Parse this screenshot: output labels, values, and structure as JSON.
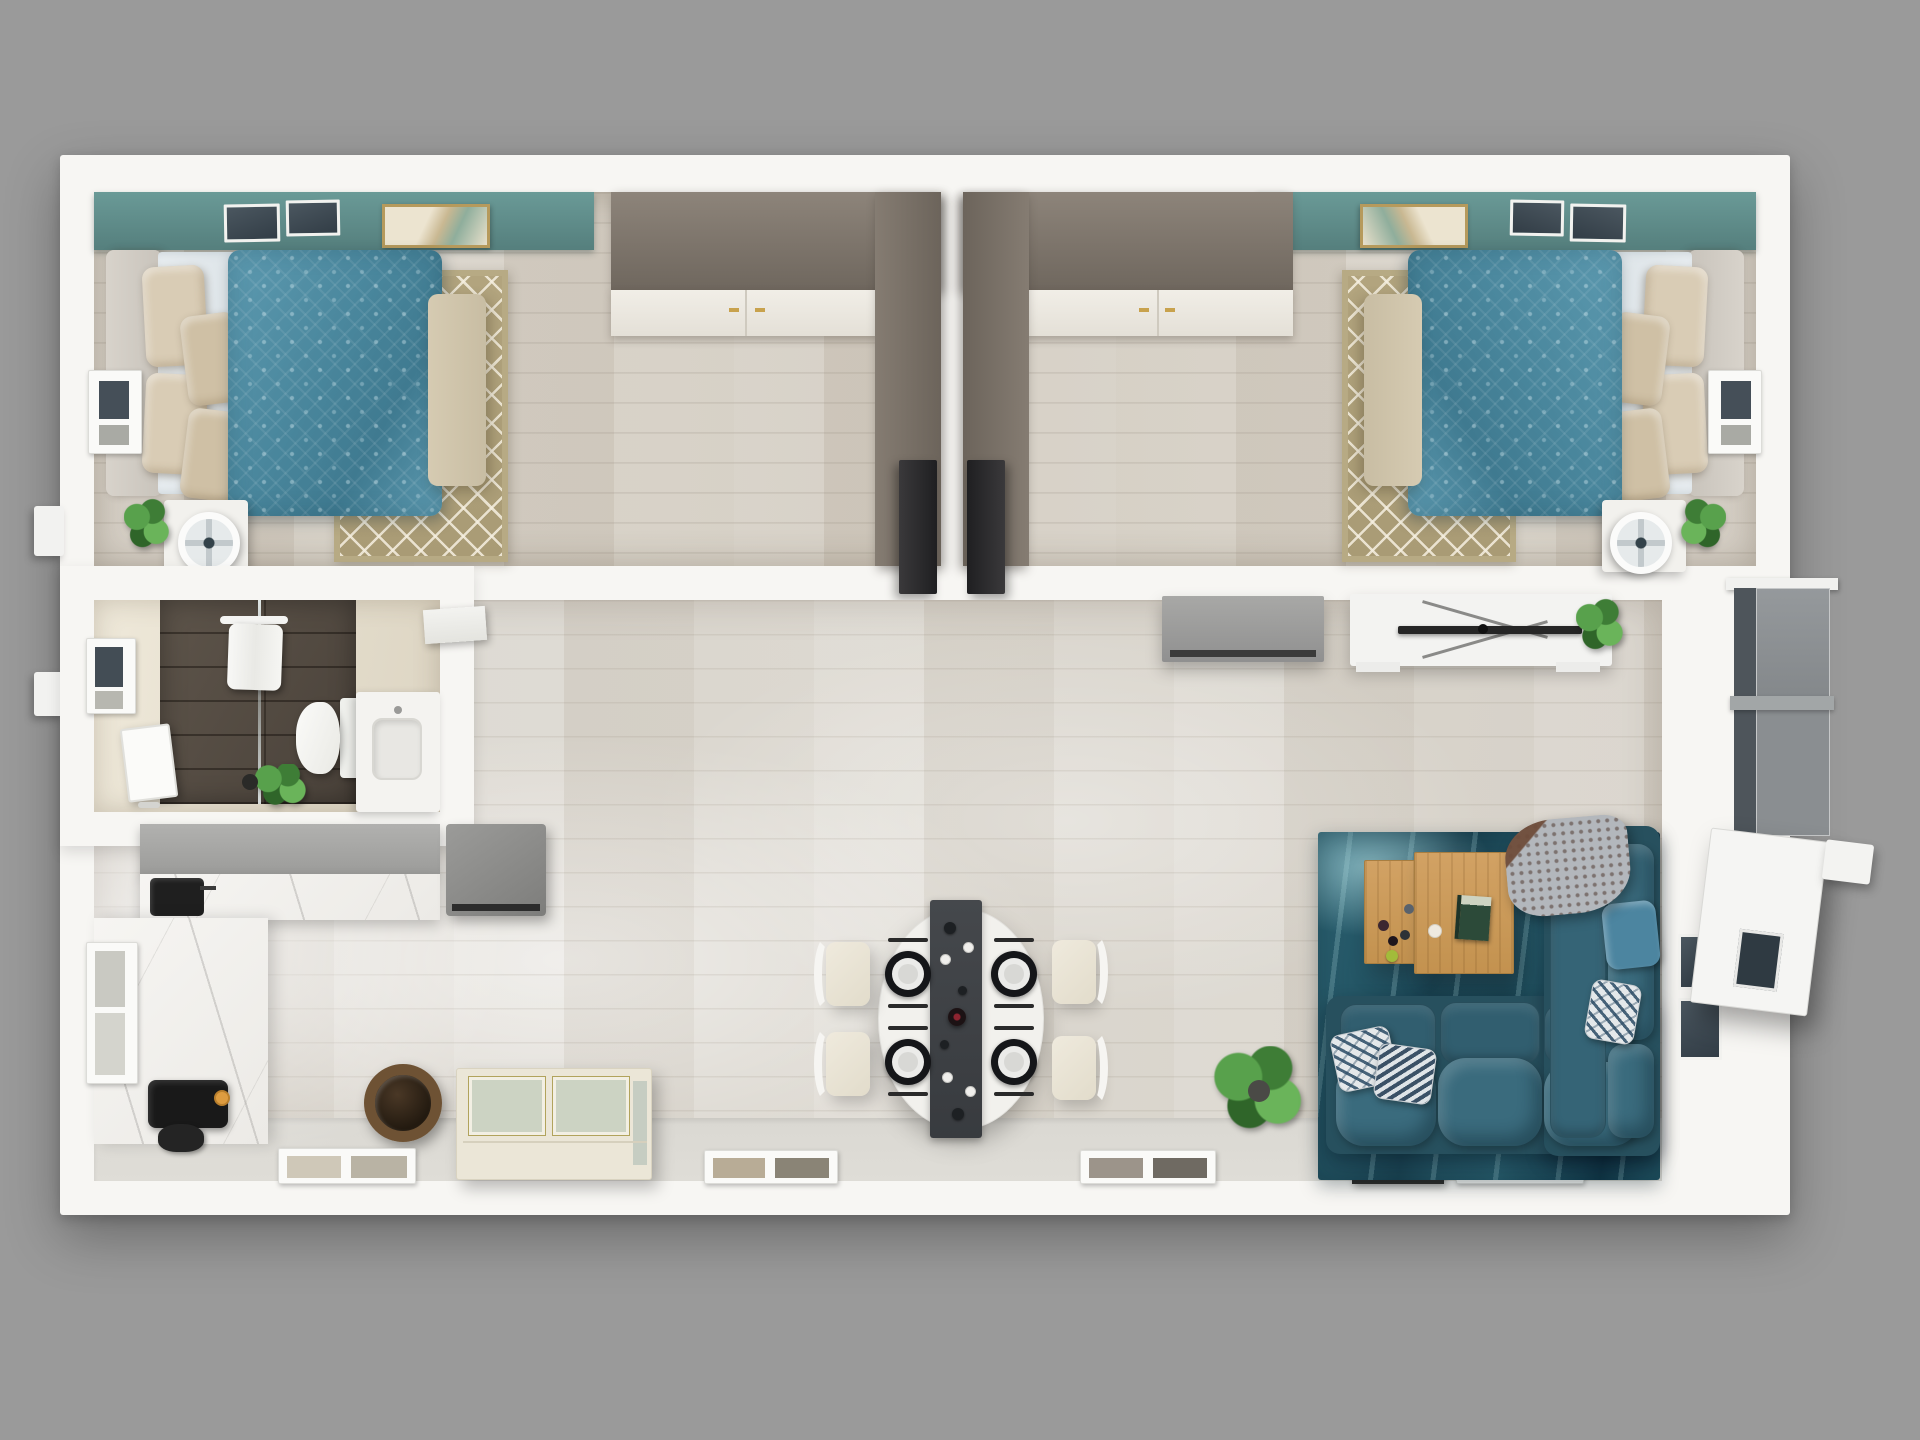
{
  "scene": {
    "description": "Top-down 3D rendered floor plan of a rectangular single-storey home with two mirrored bedrooms at the top, a bathroom at the middle-left, and an open-plan kitchen, dining and living area across the bottom, on a plain grey background.",
    "style": "photorealistic 3D floor plan render, no text labels",
    "background_color": "#9a9a9a",
    "wall_color": "#f7f6f3"
  },
  "counts": {
    "bedrooms": 2,
    "bathrooms": 1,
    "dining_seats": 4,
    "place_settings": 4
  },
  "rooms": [
    {
      "name": "Bedroom 1",
      "position": "top-left",
      "items": [
        "double bed with teal damask duvet",
        "grey upholstered headboard",
        "four beige satin pillows",
        "cream bench at foot of bed",
        "taupe diamond-pattern area rug",
        "white nightstand with fan and plant",
        "L-shaped taupe wardrobe with white cabinet doors",
        "two dark skylight windows",
        "framed wall art",
        "teal accent wall strip",
        "side wall window",
        "dark open door"
      ]
    },
    {
      "name": "Bedroom 2",
      "position": "top-right",
      "note": "mirror image of Bedroom 1",
      "items": [
        "double bed with teal damask duvet",
        "grey upholstered headboard",
        "four beige satin pillows",
        "cream bench at foot of bed",
        "taupe diamond-pattern area rug",
        "white nightstand with fan and plant",
        "L-shaped taupe wardrobe with white cabinet doors",
        "two dark skylight windows",
        "framed wall art",
        "teal accent wall strip",
        "side wall window",
        "dark open door"
      ]
    },
    {
      "name": "Bathroom",
      "position": "middle-left",
      "items": [
        "dark-tiled walk-in shower with glass partition",
        "hanging white towel",
        "white wall shelf",
        "toilet",
        "white vanity with inset sink",
        "tilted vanity mirror",
        "potted plant",
        "wall window"
      ]
    },
    {
      "name": "Kitchen",
      "position": "bottom-left",
      "items": [
        "grey upper cabinet run",
        "white marble counter strip",
        "black sink and faucet",
        "grey refrigerator unit",
        "white marble side counter",
        "black coffee machine with orange cup",
        "black kettle",
        "wicker basket",
        "cream glass-front cabinet",
        "wall window"
      ]
    },
    {
      "name": "Dining area",
      "position": "bottom-center",
      "items": [
        "white oval dining table",
        "dark table runner",
        "four black charger place settings with white plates and cutlery",
        "wine bottle",
        "wine glasses",
        "four cream chairs with white curved backs",
        "potted palm plant"
      ]
    },
    {
      "name": "Living area",
      "position": "bottom-right",
      "items": [
        "teal abstract area rug",
        "dark teal L-shaped sectional sofa",
        "two patterned throw pillows",
        "two teal accent pillows",
        "grey and brown throw blanket",
        "small oak coffee table with fruit and cups",
        "large oak coffee table with book and candle",
        "white media console with flat TV and plant",
        "grey dresser",
        "two dark windows in right wall",
        "grey sliding glass door",
        "open white entry door with window",
        "picture frame on floor near bottom wall",
        "bottom-wall windows"
      ]
    }
  ],
  "palette": {
    "background": "#9a9a9a",
    "walls": "#f7f6f3",
    "bedroom_floor": "#d5cfc5",
    "living_floor": "#d9d4cc",
    "accent_teal": "#5e8e8b",
    "duvet_teal": "#4e8ba0",
    "bedroom_rug": "#ae9f78",
    "bench_cream": "#d0c5ab",
    "wardrobe_taupe": "#7e756b",
    "bathroom_tile": "#544b41",
    "kitchen_grey": "#a6a6a4",
    "marble": "#f4f3f0",
    "living_rug_teal": "#1f4e5c",
    "sofa_teal": "#2e5d6e",
    "coffee_table_oak": "#cb9a5c",
    "chair_cream": "#eae5d7",
    "runner_grey": "#404347",
    "plant_green": "#4c9140",
    "appliance_black": "#1c1c1c",
    "cup_orange": "#dd9c40",
    "basket_brown": "#6e5234",
    "door_dark": "#2c2b2d"
  }
}
